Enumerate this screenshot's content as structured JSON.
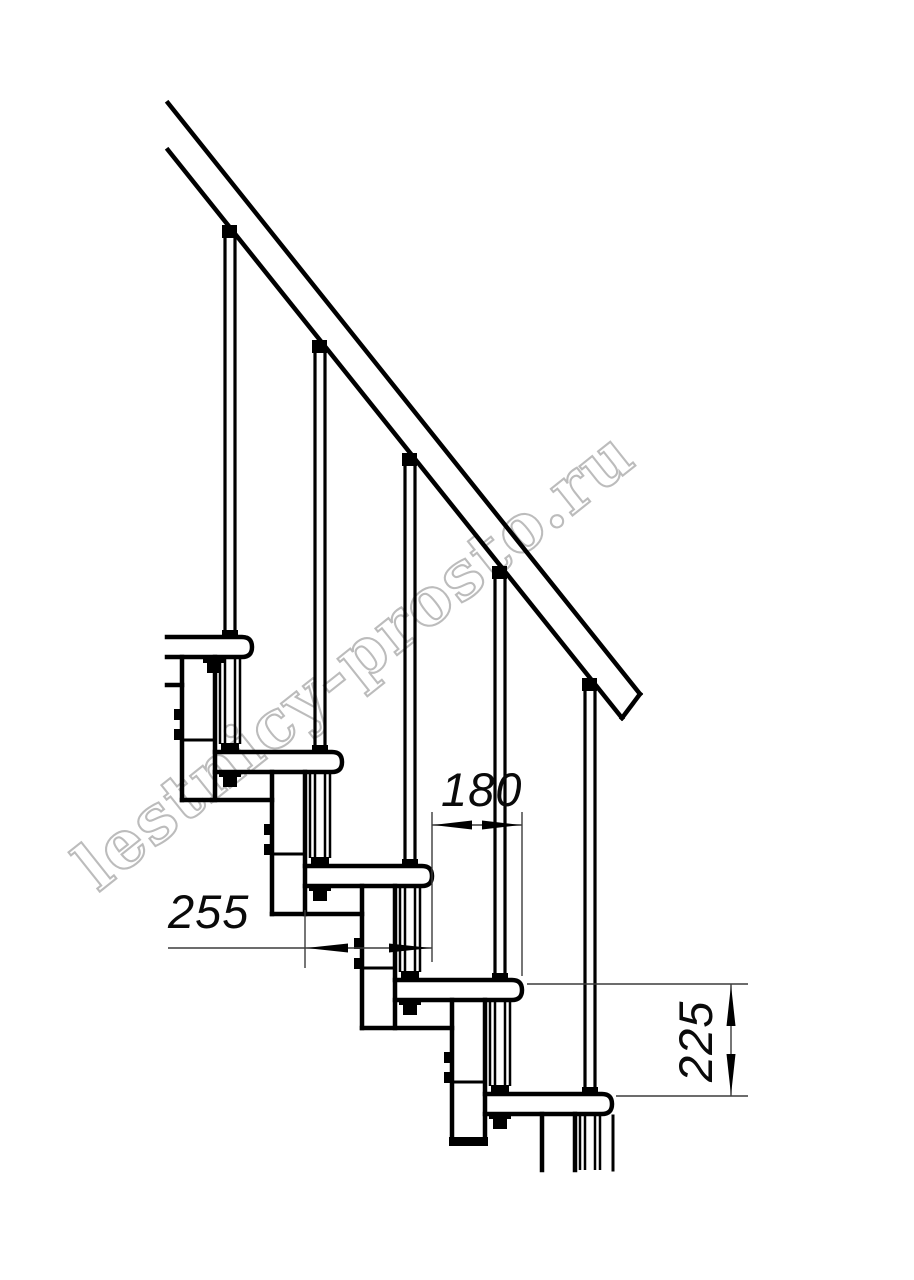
{
  "drawing": {
    "title_semantic": "modular staircase side elevation",
    "watermark": {
      "text": "lestnicy-prosto.ru",
      "color": "#bcbcbc"
    },
    "dimensions": {
      "tread_depth": {
        "value": "255",
        "orientation": "horizontal"
      },
      "step_run": {
        "value": "180",
        "orientation": "horizontal"
      },
      "step_rise": {
        "value": "225",
        "orientation": "vertical"
      }
    },
    "colors": {
      "line": "#000000",
      "dimension_line": "#3c3c3c",
      "background": "#ffffff"
    }
  }
}
